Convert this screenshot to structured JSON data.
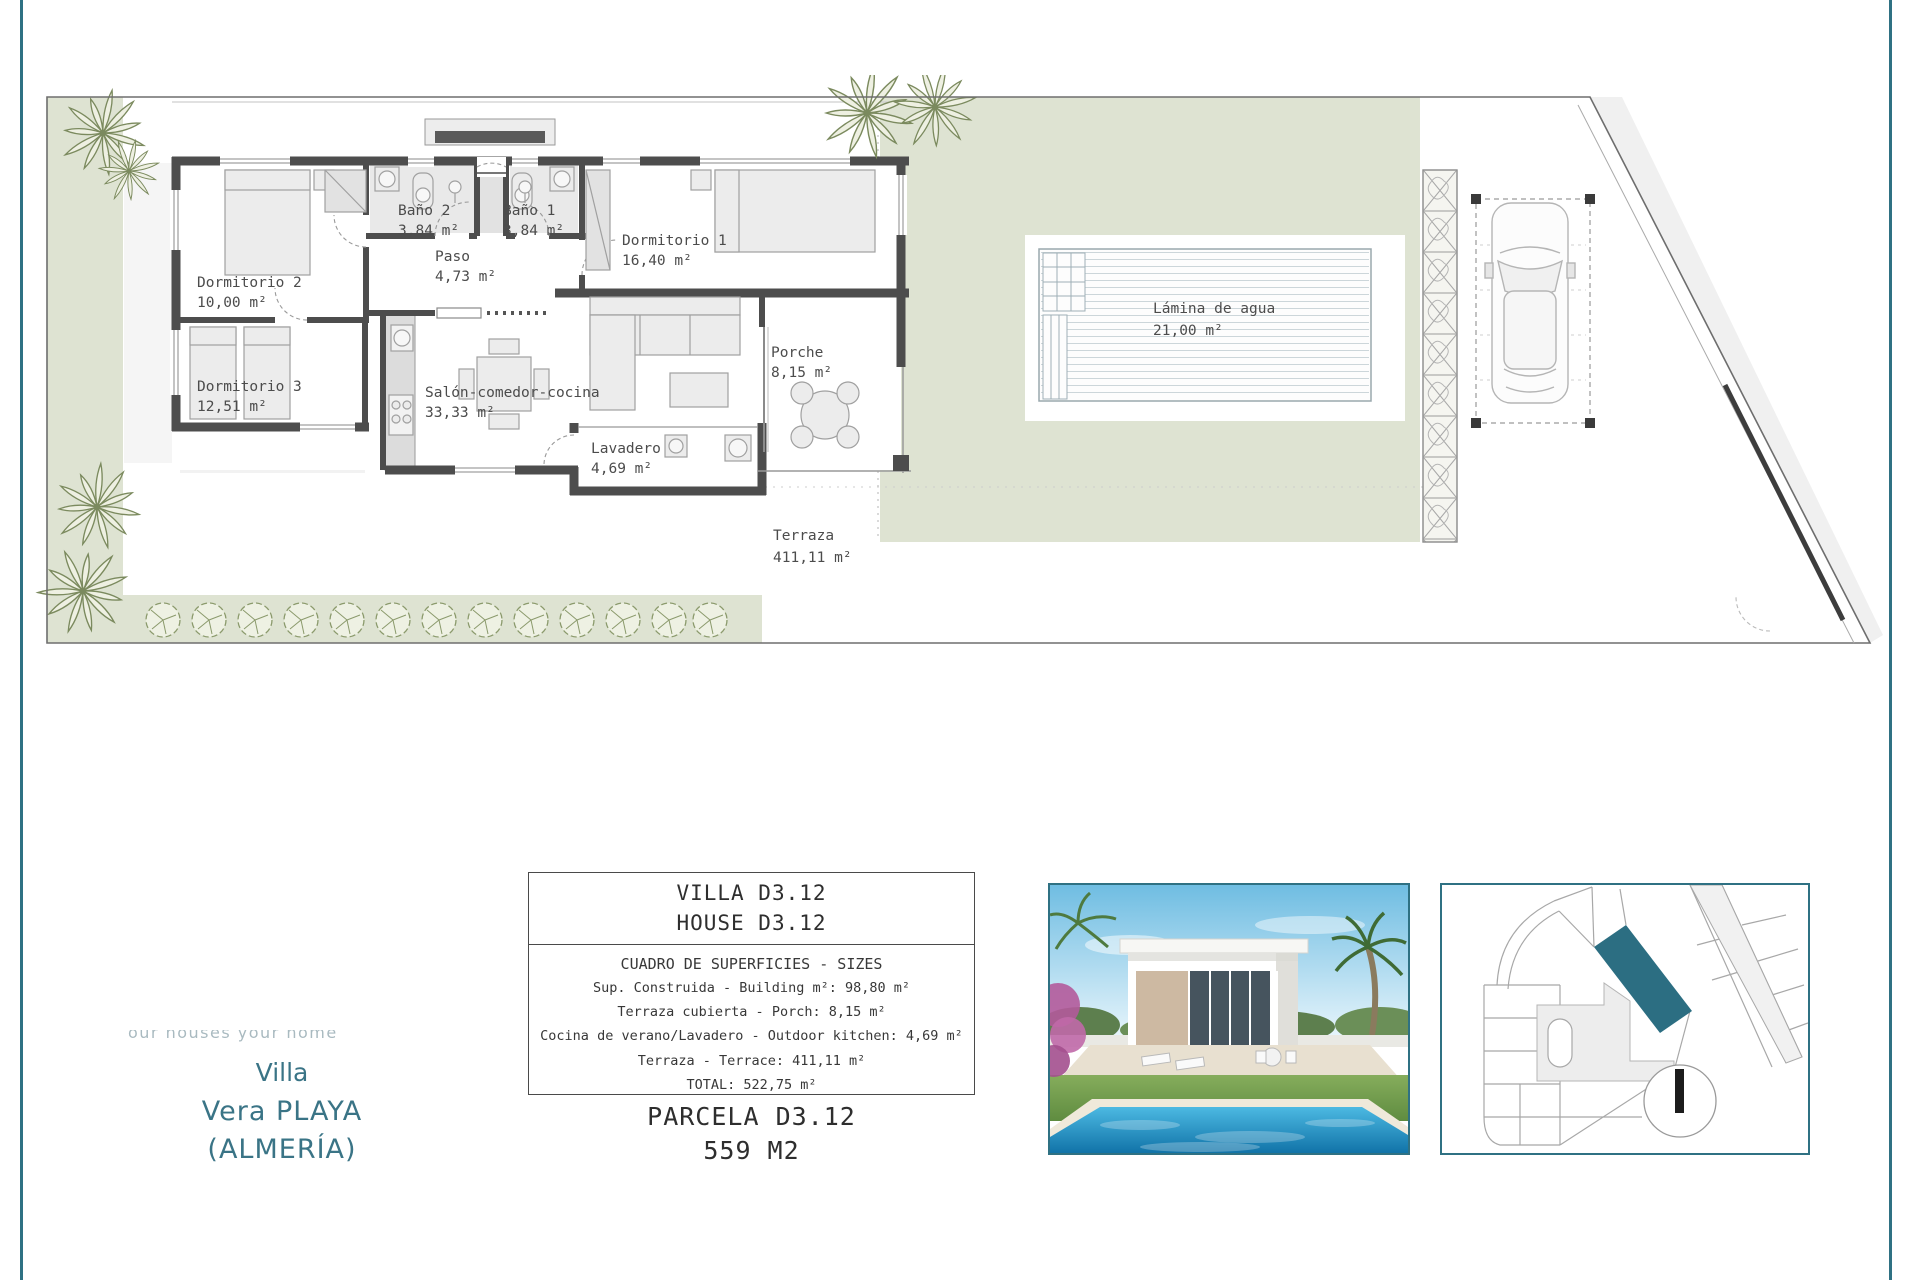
{
  "page": {
    "accent_teal": "#2f7183",
    "sage_green": "#dee3d2"
  },
  "plan": {
    "rooms": [
      {
        "name": "Dormitorio 2",
        "area": "10,00 m²"
      },
      {
        "name": "Baño 2",
        "area": "3,84 m²"
      },
      {
        "name": "Baño 1",
        "area": "3,84 m²"
      },
      {
        "name": "Dormitorio 1",
        "area": "16,40 m²"
      },
      {
        "name": "Paso",
        "area": "4,73 m²"
      },
      {
        "name": "Dormitorio 3",
        "area": "12,51 m²"
      },
      {
        "name": "Salón-comedor-cocina",
        "area": "33,33 m²"
      },
      {
        "name": "Porche",
        "area": "8,15 m²"
      },
      {
        "name": "Lavadero",
        "area": "4,69 m²"
      },
      {
        "name": "Terraza",
        "area": "411,11 m²"
      }
    ],
    "pool": {
      "name": "Lámina de agua",
      "area": "21,00 m²"
    }
  },
  "info_box": {
    "title_line1": "VILLA D3.12",
    "title_line2": "HOUSE D3.12",
    "sizes_heading": "CUADRO DE SUPERFICIES  - SIZES",
    "rows": [
      "Sup. Construida  - Building m²: 98,80 m²",
      "Terraza cubierta  - Porch: 8,15 m²",
      "Cocina de verano/Lavadero  - Outdoor kitchen: 4,69 m²",
      "Terraza - Terrace: 411,11 m²",
      "TOTAL:  522,75 m²"
    ],
    "parcel_line1": "PARCELA D3.12",
    "parcel_line2": "559 M2"
  },
  "brand": {
    "tagline": "our houses your home",
    "line1": "Villa",
    "line2": "Vera PLAYA",
    "line3": "(ALMERÍA)"
  }
}
